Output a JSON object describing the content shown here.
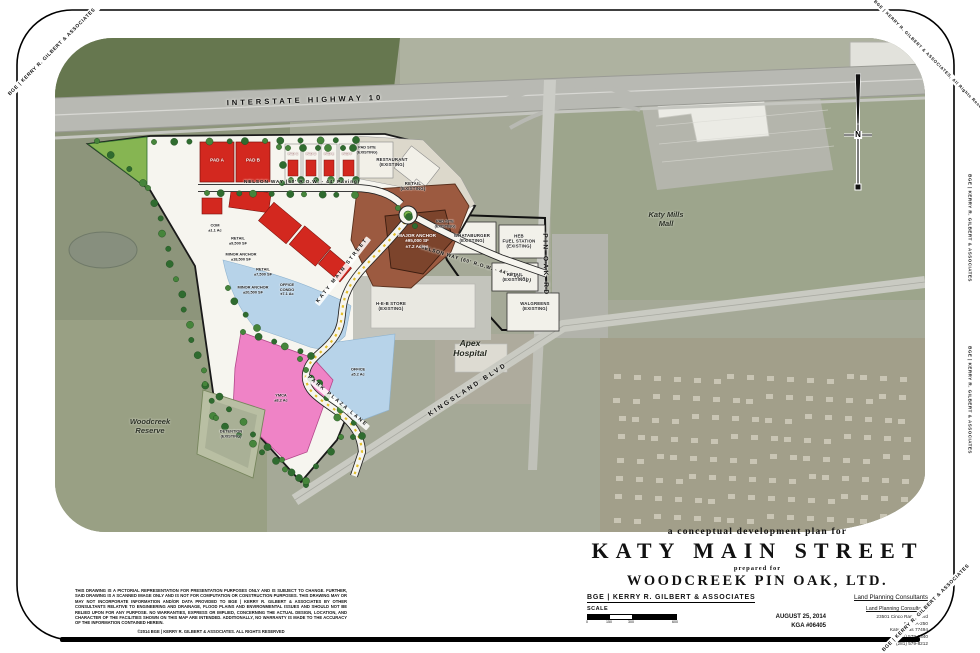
{
  "frame": {
    "corner_tl": "BGE | KERRY R. GILBERT & ASSOCIATES",
    "corner_tr": "©2014 BGE | KERRY R. GILBERT & ASSOCIATES, All Rights Reserved",
    "corner_br": "BGE | KERRY R. GILBERT & ASSOCIATES",
    "edge_right_upper": "BGE | KERRY R. GILBERT & ASSOCIATES",
    "edge_right_lower": "BGE | KERRY R. GILBERT & ASSOCIATES"
  },
  "map": {
    "labels": [
      {
        "name": "label-interstate-highway-10",
        "lines": [
          "INTERSTATE  HIGHWAY  10"
        ],
        "x": 250,
        "y": 63,
        "rot": -2,
        "cls": "road"
      },
      {
        "name": "label-nelson-way",
        "lines": [
          "NELSON WAY   (60' R.O.W. - 44' Paving)"
        ],
        "x": 247,
        "y": 145,
        "rot": 0,
        "cls": "road-sm"
      },
      {
        "name": "label-nelson-way-east",
        "lines": [
          "NELSON WAY  (60' R.O.W. - 44' Paving)"
        ],
        "x": 421,
        "y": 227,
        "rot": 17,
        "cls": "road-sm"
      },
      {
        "name": "label-pin-oak-rd",
        "lines": [
          "PIN OAK RD"
        ],
        "x": 490,
        "y": 227,
        "rot": 89,
        "cls": "road-spaced"
      },
      {
        "name": "label-kingsland-blvd",
        "lines": [
          "KINGSLAND BLVD"
        ],
        "x": 413,
        "y": 352,
        "rot": -33,
        "cls": "road-spaced"
      },
      {
        "name": "label-katy-main-street",
        "lines": [
          "KATY MAIN STREET"
        ],
        "x": 288,
        "y": 233,
        "rot": -52,
        "cls": "chip"
      },
      {
        "name": "label-park-plaza-lane",
        "lines": [
          "PARK PLAZA LANE"
        ],
        "x": 282,
        "y": 364,
        "rot": 40,
        "cls": "chip"
      },
      {
        "name": "label-katy-mills-mall",
        "lines": [
          "Katy Mills",
          "Mall"
        ],
        "x": 611,
        "y": 182,
        "rot": 0,
        "cls": "aerial"
      },
      {
        "name": "label-woodcreek-reserve",
        "lines": [
          "Woodcreek",
          "Reserve"
        ],
        "x": 95,
        "y": 389,
        "rot": 0,
        "cls": "aerial"
      },
      {
        "name": "label-apex-hospital",
        "lines": [
          "Apex",
          "Hospital"
        ],
        "x": 415,
        "y": 310,
        "rot": 0,
        "cls": "aerial-lg"
      },
      {
        "name": "label-heb-store",
        "lines": [
          "H-E-B STORE",
          "(EXISTING)"
        ],
        "x": 336,
        "y": 268,
        "rot": 0,
        "cls": "site"
      },
      {
        "name": "label-whataburger",
        "lines": [
          "WHATABURGER",
          "(EXISTING)"
        ],
        "x": 417,
        "y": 200,
        "rot": 0,
        "cls": "site"
      },
      {
        "name": "label-heb-fuel-station",
        "lines": [
          "HEB",
          "FUEL STATION",
          "(EXISTING)"
        ],
        "x": 464,
        "y": 203,
        "rot": 0,
        "cls": "site"
      },
      {
        "name": "label-pad-site-existing-east",
        "lines": [
          "PAD SITE",
          "(EXISTING)"
        ],
        "x": 390,
        "y": 186,
        "rot": 0,
        "cls": "site-sm"
      },
      {
        "name": "label-retail-existing-1",
        "lines": [
          "RETAIL",
          "(EXISTING)"
        ],
        "x": 460,
        "y": 239,
        "rot": 0,
        "cls": "site"
      },
      {
        "name": "label-walgreens",
        "lines": [
          "WALGREENS",
          "(EXISTING)"
        ],
        "x": 480,
        "y": 268,
        "rot": 0,
        "cls": "site"
      },
      {
        "name": "label-restaurant-existing",
        "lines": [
          "RESTAURANT",
          "(EXISTING)"
        ],
        "x": 337,
        "y": 124,
        "rot": 0,
        "cls": "site"
      },
      {
        "name": "label-retail-existing-2",
        "lines": [
          "RETAIL",
          "(EXISTING)"
        ],
        "x": 358,
        "y": 148,
        "rot": 0,
        "cls": "site"
      },
      {
        "name": "label-pad-site-existing-top",
        "lines": [
          "PAD SITE",
          "(EXISTING)"
        ],
        "x": 312,
        "y": 112,
        "rot": 0,
        "cls": "site-sm"
      },
      {
        "name": "label-pad-a",
        "lines": [
          "PAD A"
        ],
        "x": 162,
        "y": 122,
        "rot": 0,
        "cls": "white"
      },
      {
        "name": "label-pad-b",
        "lines": [
          "PAD B"
        ],
        "x": 198,
        "y": 122,
        "rot": 0,
        "cls": "white"
      },
      {
        "name": "label-pad-c",
        "lines": [
          "PAD C"
        ],
        "x": 238,
        "y": 116,
        "rot": 0,
        "cls": "site-xs"
      },
      {
        "name": "label-pad-d",
        "lines": [
          "PAD D"
        ],
        "x": 256,
        "y": 116,
        "rot": 0,
        "cls": "site-xs"
      },
      {
        "name": "label-pad-e",
        "lines": [
          "PAD E"
        ],
        "x": 274,
        "y": 116,
        "rot": 0,
        "cls": "site-xs"
      },
      {
        "name": "label-pad-f",
        "lines": [
          "PAD F"
        ],
        "x": 292,
        "y": 116,
        "rot": 0,
        "cls": "site-xs"
      },
      {
        "name": "label-comm",
        "lines": [
          "COM",
          "±1.1 Ac"
        ],
        "x": 160,
        "y": 190,
        "rot": 0,
        "cls": "site-sm"
      },
      {
        "name": "label-retail-1",
        "lines": [
          "RETAIL",
          "±9,500 SF"
        ],
        "x": 183,
        "y": 203,
        "rot": 0,
        "cls": "site-sm"
      },
      {
        "name": "label-minor-anchor-1",
        "lines": [
          "MINOR ANCHOR",
          "±18,500 SF"
        ],
        "x": 186,
        "y": 219,
        "rot": 0,
        "cls": "site-sm"
      },
      {
        "name": "label-retail-2",
        "lines": [
          "RETAIL",
          "±7,500 SF"
        ],
        "x": 208,
        "y": 234,
        "rot": 0,
        "cls": "site-sm"
      },
      {
        "name": "label-minor-anchor-2",
        "lines": [
          "MINOR ANCHOR",
          "±20,500 SF"
        ],
        "x": 198,
        "y": 252,
        "rot": 0,
        "cls": "site-sm"
      },
      {
        "name": "label-major-anchor",
        "lines": [
          "MAJOR ANCHOR",
          "±95,000 SF",
          "±7.2 Acres"
        ],
        "x": 362,
        "y": 203,
        "rot": 0,
        "cls": "white"
      },
      {
        "name": "label-office-condo",
        "lines": [
          "OFFICE",
          "CONDO",
          "±7.1 Ac"
        ],
        "x": 232,
        "y": 252,
        "rot": 0,
        "cls": "site-sm"
      },
      {
        "name": "label-office",
        "lines": [
          "OFFICE",
          "±5.2 Ac"
        ],
        "x": 303,
        "y": 334,
        "rot": 0,
        "cls": "site-sm"
      },
      {
        "name": "label-ymca",
        "lines": [
          "YMCA",
          "±8.2 Ac"
        ],
        "x": 226,
        "y": 360,
        "rot": 0,
        "cls": "site-sm"
      },
      {
        "name": "label-detention",
        "lines": [
          "DETENTION",
          "(EXISTING)"
        ],
        "x": 176,
        "y": 396,
        "rot": 0,
        "cls": "site-sm"
      },
      {
        "name": "label-north",
        "lines": [
          "N"
        ],
        "x": 803,
        "y": 97,
        "rot": 0,
        "cls": "north"
      }
    ]
  },
  "title_block": {
    "tagline": "a conceptual development plan for",
    "title": "KATY MAIN STREET",
    "prepared_for": "prepared for",
    "client": "WOODCREEK PIN OAK, LTD.",
    "firm": "BGE | KERRY R. GILBERT & ASSOCIATES",
    "consultant_type": "Land Planning Consultants",
    "address_lines": [
      "23501 Cinco Ranch Blvd",
      "Suite A-250",
      "Katy, Texas 77494",
      "(281) 579-0340",
      "Fax (281) 579-8212"
    ],
    "scale_label": "SCALE",
    "scale_ticks": [
      "0",
      "150",
      "300",
      "600"
    ],
    "date": "AUGUST 25, 2014",
    "job_number": "KGA #06405"
  },
  "disclaimer": {
    "text": "THIS DRAWING IS A PICTORIAL REPRESENTATION FOR PRESENTATION PURPOSES ONLY AND IS SUBJECT TO CHANGE. FURTHER, SAID DRAWING IS A SCANNED IMAGE ONLY AND IS NOT FOR COMPUTATION OR CONSTRUCTION PURPOSES. THIS DRAWING MAY OR MAY NOT INCORPORATE INFORMATION AND/OR DATA PROVIDED TO BGE | KERRY R. GILBERT & ASSOCIATES BY OTHER CONSULTANTS RELATIVE TO ENGINEERING AND DRAINAGE, FLOOD PLAINS AND ENVIRONMENTAL ISSUES AND SHOULD NOT BE RELIED UPON FOR ANY PURPOSE.  NO WARRANTIES, EXPRESS OR IMPLIED, CONCERNING THE ACTUAL DESIGN, LOCATION, AND CHARACTER OF THE FACILITIES SHOWN ON THIS MAP ARE INTENDED.  ADDITIONALLY, NO WARRANTY IS MADE TO THE ACCURACY OF THE INFORMATION CONTAINED HEREIN.",
    "copyright": "©2014 BGE | KERRY R. GILBERT & ASSOCIATES. ALL RIGHTS RESERVED"
  },
  "colors": {
    "plan_red": "#d3281f",
    "anchor_brown": "#9c5a40",
    "water_blue": "#b7d3e9",
    "ymca_pink": "#ef83c6",
    "plan_white": "#f6f5ef",
    "tree_green": "#2f6b2f",
    "street_yellow": "#e3bf2e"
  }
}
